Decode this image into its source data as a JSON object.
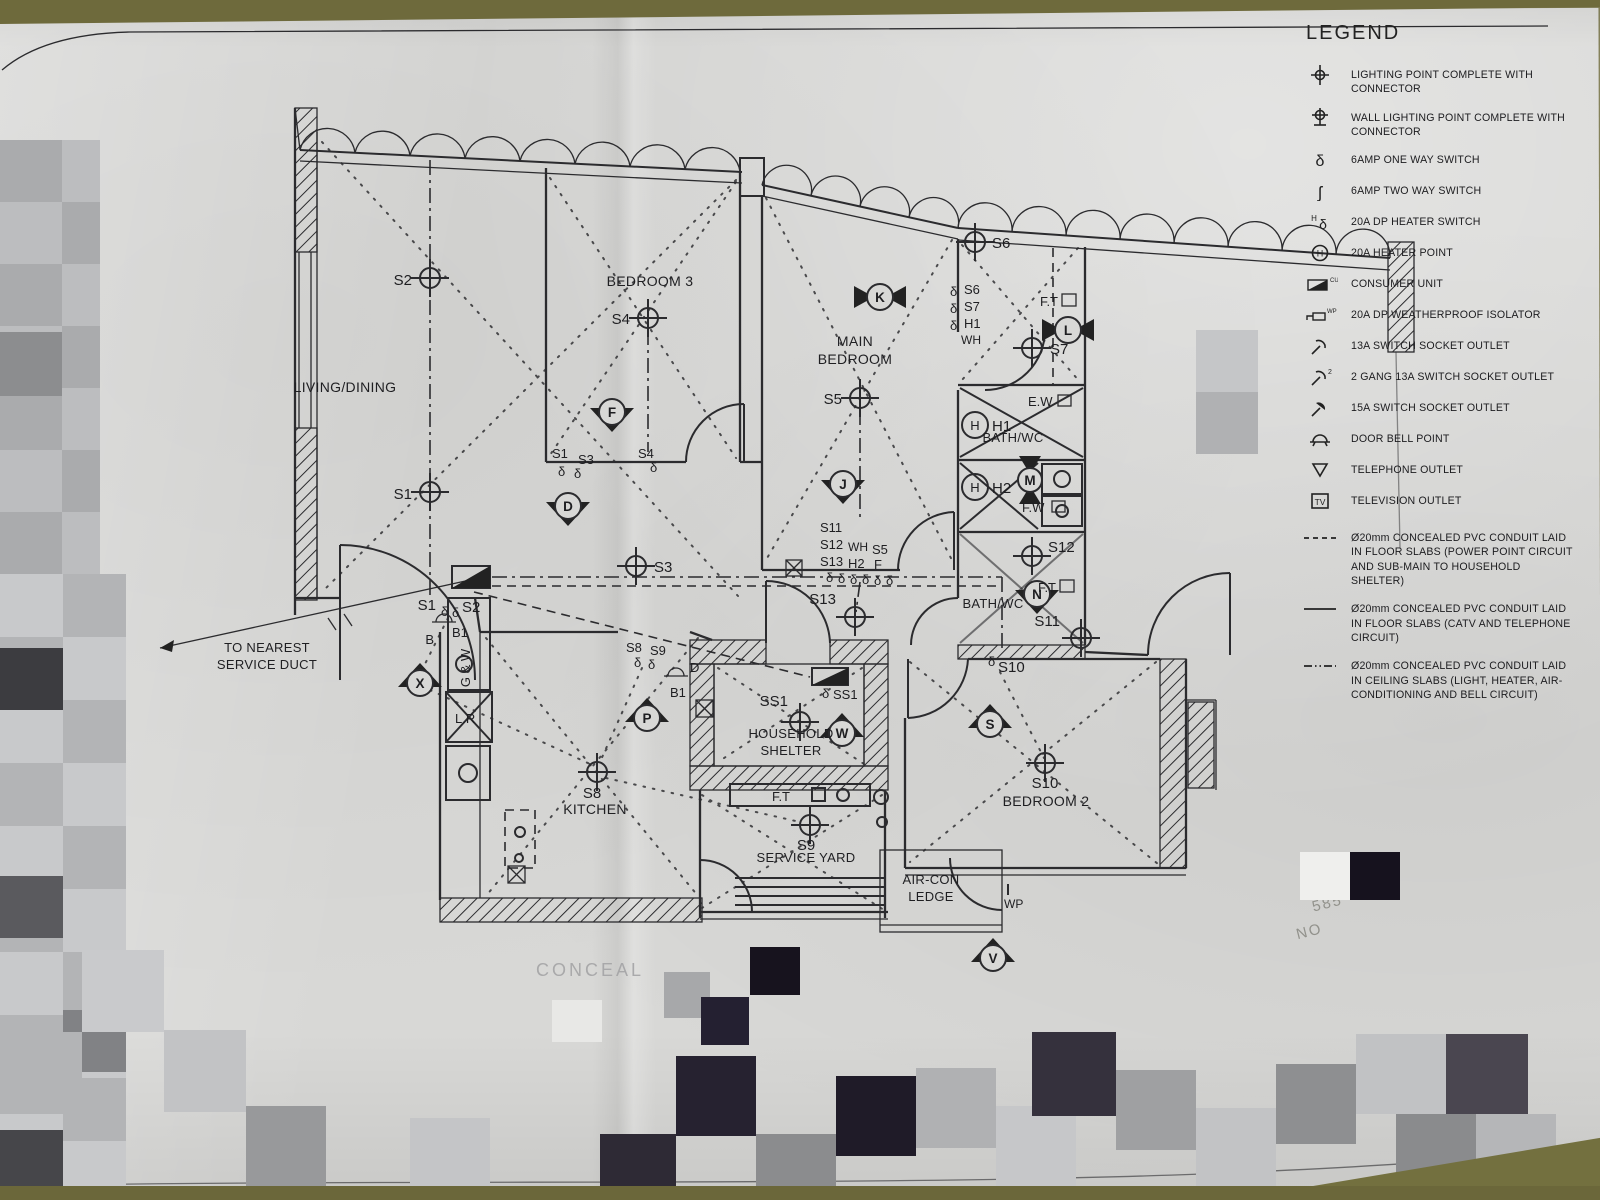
{
  "glyphs": {
    "one_way": "δ",
    "two_way": "ʃ",
    "h": "H",
    "cu": "CU",
    "wp": "WP",
    "two": "2",
    "tv": "TV"
  },
  "legend": {
    "title": "LEGEND",
    "items": [
      {
        "icon": "lighting-point",
        "label": "LIGHTING POINT COMPLETE WITH CONNECTOR"
      },
      {
        "icon": "wall-lighting-point",
        "label": "WALL LIGHTING POINT COMPLETE WITH CONNECTOR"
      },
      {
        "icon": "one-way-switch",
        "label": "6AMP ONE WAY SWITCH"
      },
      {
        "icon": "two-way-switch",
        "label": "6AMP TWO WAY SWITCH"
      },
      {
        "icon": "heater-switch",
        "label": "20A DP HEATER SWITCH"
      },
      {
        "icon": "heater-point",
        "label": "20A HEATER POINT"
      },
      {
        "icon": "consumer-unit",
        "label": "CONSUMER UNIT"
      },
      {
        "icon": "weatherproof-isolator",
        "label": "20A DP WEATHERPROOF ISOLATOR"
      },
      {
        "icon": "socket-13a",
        "label": "13A SWITCH SOCKET OUTLET"
      },
      {
        "icon": "socket-13a-2gang",
        "label": "2 GANG 13A SWITCH SOCKET OUTLET"
      },
      {
        "icon": "socket-15a",
        "label": "15A SWITCH SOCKET OUTLET"
      },
      {
        "icon": "door-bell",
        "label": "DOOR BELL POINT"
      },
      {
        "icon": "telephone-outlet",
        "label": "TELEPHONE OUTLET"
      },
      {
        "icon": "television-outlet",
        "label": "TELEVISION OUTLET"
      },
      {
        "icon": "conduit-dashed",
        "label": "Ø20mm CONCEALED PVC CONDUIT LAID IN FLOOR SLABS (POWER POINT CIRCUIT AND SUB-MAIN TO HOUSEHOLD SHELTER)"
      },
      {
        "icon": "conduit-solid",
        "label": "Ø20mm CONCEALED PVC CONDUIT LAID IN FLOOR SLABS (CATV AND TELEPHONE CIRCUIT)"
      },
      {
        "icon": "conduit-dashdot",
        "label": "Ø20mm CONCEALED PVC CONDUIT LAID IN CEILING SLABS (LIGHT, HEATER, AIR-CONDITIONING AND BELL CIRCUIT)"
      }
    ]
  },
  "plan": {
    "rooms": {
      "living": "LIVING/DINING",
      "bedroom3": "BEDROOM 3",
      "main_bedroom": "MAIN BEDROOM",
      "bath_upper": "BATH/WC",
      "bath_lower": "BATH/WC",
      "kitchen": "KITCHEN",
      "household_shelter": "HOUSEHOLD SHELTER",
      "service_yard": "SERVICE YARD",
      "bedroom2": "BEDROOM 2",
      "aircon_ledge": "AIR-CON LEDGE"
    },
    "notes": {
      "service_duct": "TO NEAREST SERVICE DUCT"
    },
    "lights": {
      "s1": "S1",
      "s2": "S2",
      "s3": "S3",
      "s4": "S4",
      "s5": "S5",
      "s6": "S6",
      "s7": "S7",
      "s8": "S8",
      "s9": "S9",
      "s10": "S10",
      "s11": "S11",
      "s12": "S12",
      "s13": "S13",
      "ss1": "SS1"
    },
    "fans": {
      "f": "F",
      "d": "D",
      "k": "K",
      "l": "L",
      "j": "J",
      "m": "M",
      "n": "N",
      "p": "P",
      "w": "W",
      "x": "X",
      "s": "S",
      "v": "V"
    },
    "tags": {
      "h1": "H1",
      "h2": "H2",
      "wh": "WH",
      "wp": "WP",
      "b1": "B1",
      "b": "B",
      "ft": "F.T",
      "ew": "E.W",
      "fw": "F.W",
      "gw": "G & W",
      "lr": "L.R"
    }
  },
  "photo": {
    "stamp_line1": "585",
    "stamp_line2": "NO",
    "footer_partial": "CONCEAL",
    "drawing_ref": "/ SK / EL1-1"
  }
}
